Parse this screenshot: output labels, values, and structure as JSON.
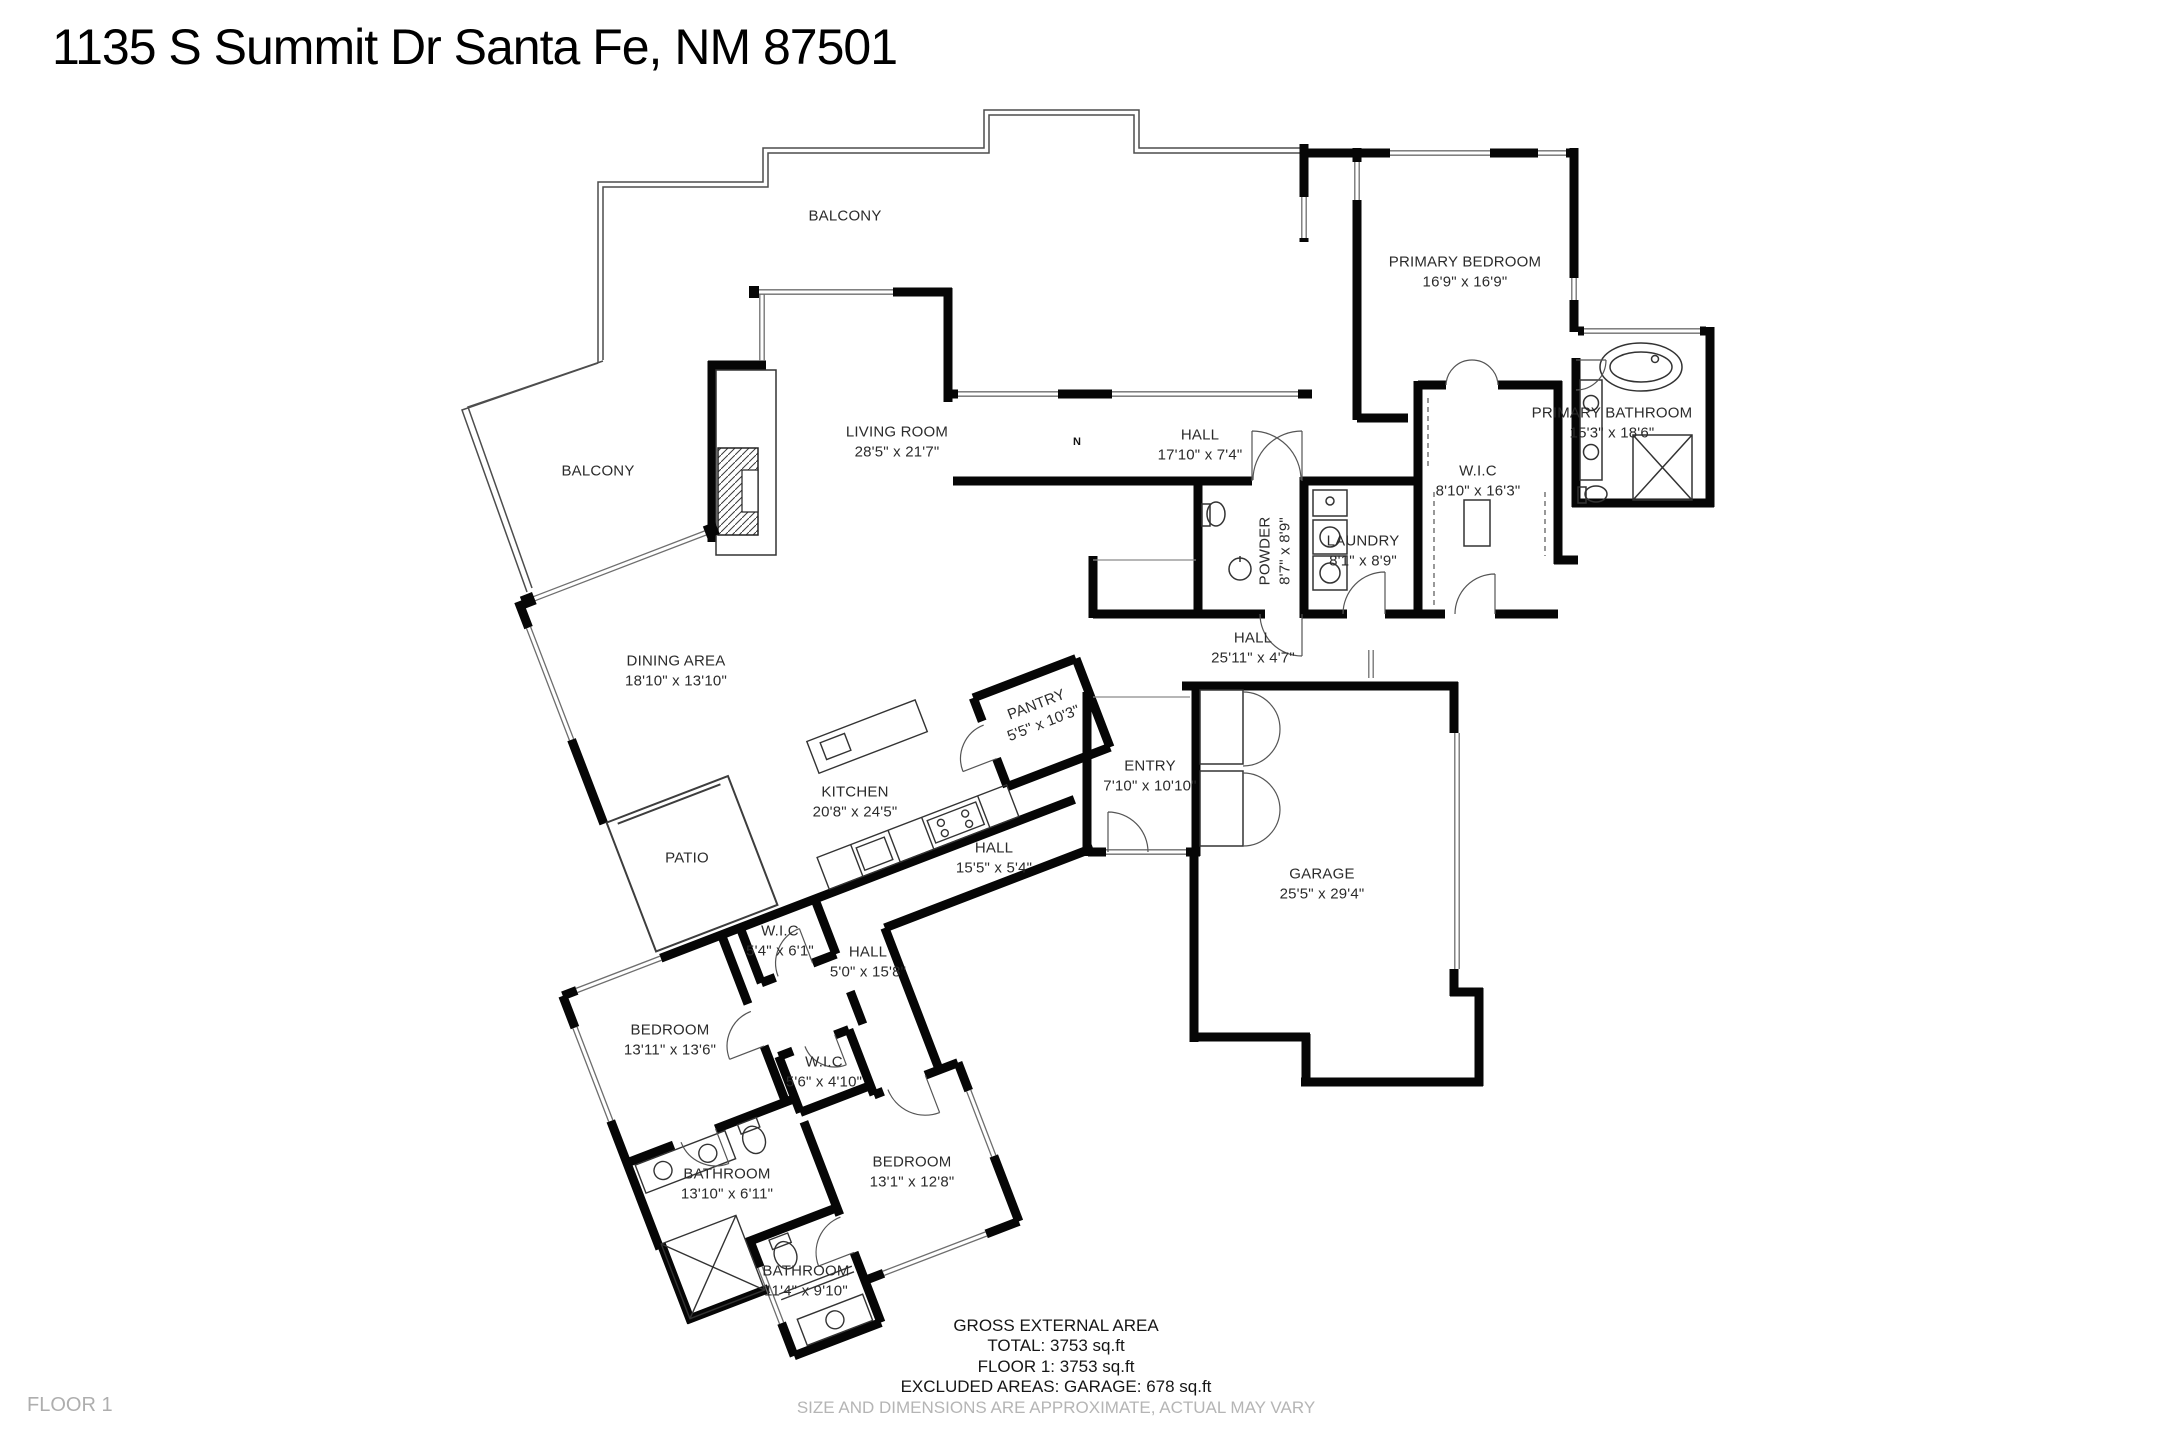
{
  "title": "1135 S Summit Dr Santa Fe, NM 87501",
  "floor_marker": "FLOOR 1",
  "north_indicator": "N",
  "colors": {
    "wall": "#060606",
    "muted_text": "#b5b5b5"
  },
  "rooms": [
    {
      "name": "BALCONY",
      "dims": ""
    },
    {
      "name": "BALCONY",
      "dims": ""
    },
    {
      "name": "LIVING ROOM",
      "dims": "28'5\" x 21'7\""
    },
    {
      "name": "HALL",
      "dims": "17'10\" x 7'4\""
    },
    {
      "name": "PRIMARY BEDROOM",
      "dims": "16'9\" x 16'9\""
    },
    {
      "name": "PRIMARY BATHROOM",
      "dims": "15'3\" x 18'6\""
    },
    {
      "name": "W.I.C",
      "dims": "8'10\" x 16'3\""
    },
    {
      "name": "POWDER",
      "dims": "8'7\" x 8'9\""
    },
    {
      "name": "LAUNDRY",
      "dims": "8'1\" x 8'9\""
    },
    {
      "name": "HALL",
      "dims": "25'11\" x 4'7\""
    },
    {
      "name": "PANTRY",
      "dims": "5'5\" x 10'3\""
    },
    {
      "name": "ENTRY",
      "dims": "7'10\" x 10'10\""
    },
    {
      "name": "HALL",
      "dims": "15'5\" x 5'4\""
    },
    {
      "name": "GARAGE",
      "dims": "25'5\" x 29'4\""
    },
    {
      "name": "DINING AREA",
      "dims": "18'10\" x 13'10\""
    },
    {
      "name": "KITCHEN",
      "dims": "20'8\" x 24'5\""
    },
    {
      "name": "PATIO",
      "dims": ""
    },
    {
      "name": "W.I.C",
      "dims": "5'4\" x 6'1\""
    },
    {
      "name": "HALL",
      "dims": "5'0\" x 15'8\""
    },
    {
      "name": "BEDROOM",
      "dims": "13'11\" x 13'6\""
    },
    {
      "name": "W.I.C",
      "dims": "5'6\" x 4'10\""
    },
    {
      "name": "BEDROOM",
      "dims": "13'1\" x 12'8\""
    },
    {
      "name": "BATHROOM",
      "dims": "13'10\" x 6'11\""
    },
    {
      "name": "BATHROOM",
      "dims": "11'4\" x 9'10\""
    }
  ],
  "summary": {
    "gross_heading": "GROSS EXTERNAL AREA",
    "total": "TOTAL: 3753 sq.ft",
    "floor1": "FLOOR 1: 3753 sq.ft",
    "excluded": "EXCLUDED AREAS: GARAGE: 678 sq.ft",
    "disclaimer": "SIZE AND DIMENSIONS ARE APPROXIMATE, ACTUAL MAY VARY"
  }
}
